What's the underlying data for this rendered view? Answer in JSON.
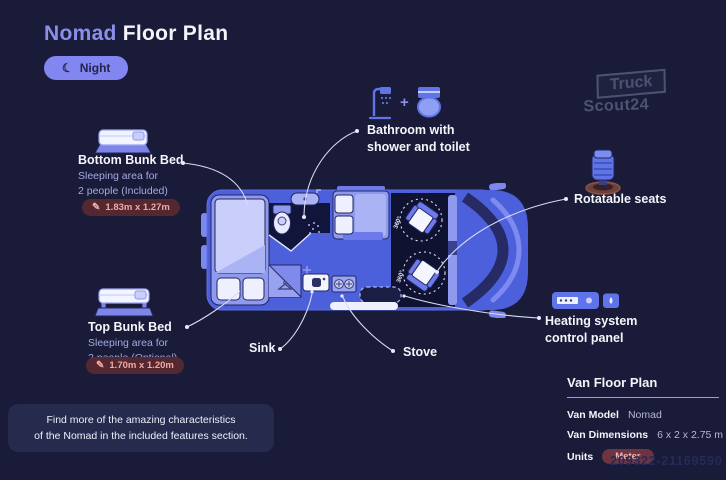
{
  "page": {
    "background": "#191b38",
    "title": {
      "accent": "Nomad",
      "rest": "Floor Plan"
    },
    "mode_toggle": {
      "label": "Night",
      "icon_glyph": "☾"
    }
  },
  "logo": {
    "line1": "Truck",
    "line2": "Scout24"
  },
  "features": {
    "bottom_bunk": {
      "title": "Bottom Bunk Bed",
      "subtitle_line1": "Sleeping area for",
      "subtitle_line2": "2 people (Included)",
      "dimensions": "1.83m x 1.27m",
      "pencil_glyph": "✎"
    },
    "top_bunk": {
      "title": "Top Bunk Bed",
      "subtitle_line1": "Sleeping area for",
      "subtitle_line2": "2 people (Optional)",
      "dimensions": "1.70m x 1.20m",
      "pencil_glyph": "✎"
    },
    "bathroom": {
      "plus": "+",
      "label_line1": "Bathroom with",
      "label_line2": "shower and toilet"
    },
    "rotatable_seats": {
      "label": "Rotatable seats"
    },
    "heating": {
      "label_line1": "Heating system",
      "label_line2": "control panel"
    },
    "sink": {
      "label": "Sink"
    },
    "stove": {
      "label": "Stove"
    }
  },
  "floorplan": {
    "seat_rotation_label": "360°"
  },
  "note": {
    "line1": "Find more of the amazing characteristics",
    "line2": "of the Nomad in the included features section."
  },
  "spec_panel": {
    "title": "Van Floor Plan",
    "rows": [
      {
        "label": "Van Model",
        "value": "Nomad"
      },
      {
        "label": "Van Dimensions",
        "value": "6 x 2 x 2.75 m"
      },
      {
        "label": "Units",
        "value": "Meter"
      }
    ]
  },
  "watermark": "209322-21169590",
  "colors": {
    "accent_periwinkle": "#8a90ea",
    "van_blue": "#4d60dc",
    "badge_bg": "#542830",
    "badge_text": "#f2a9a4",
    "night_button_bg": "#8286f0",
    "note_bg": "#262a4d"
  }
}
